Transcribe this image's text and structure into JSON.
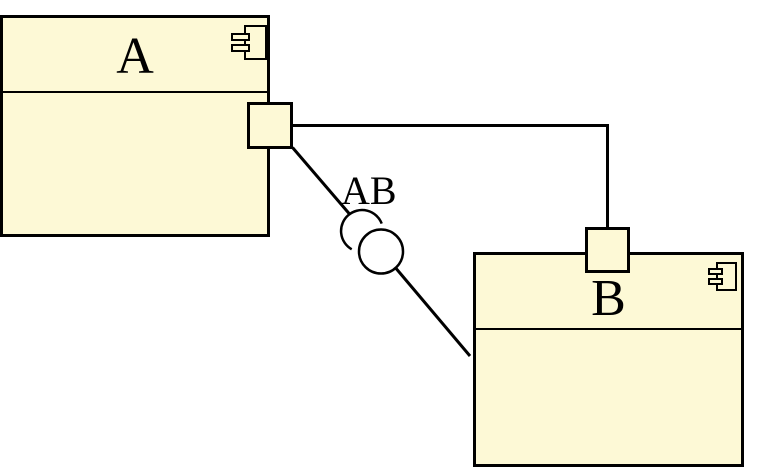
{
  "diagram": {
    "kind": "uml-component-diagram",
    "background_color": "#ffffff",
    "component_fill_color": "#fdf9d6",
    "stroke_color": "#000000"
  },
  "components": [
    {
      "label": "A"
    },
    {
      "label": "B"
    }
  ],
  "connector": {
    "label": "AB",
    "notation": "ball-and-socket"
  },
  "icons": {
    "component_icon": "uml-component-icon",
    "socket": "required-interface-socket",
    "ball": "provided-interface-ball"
  }
}
